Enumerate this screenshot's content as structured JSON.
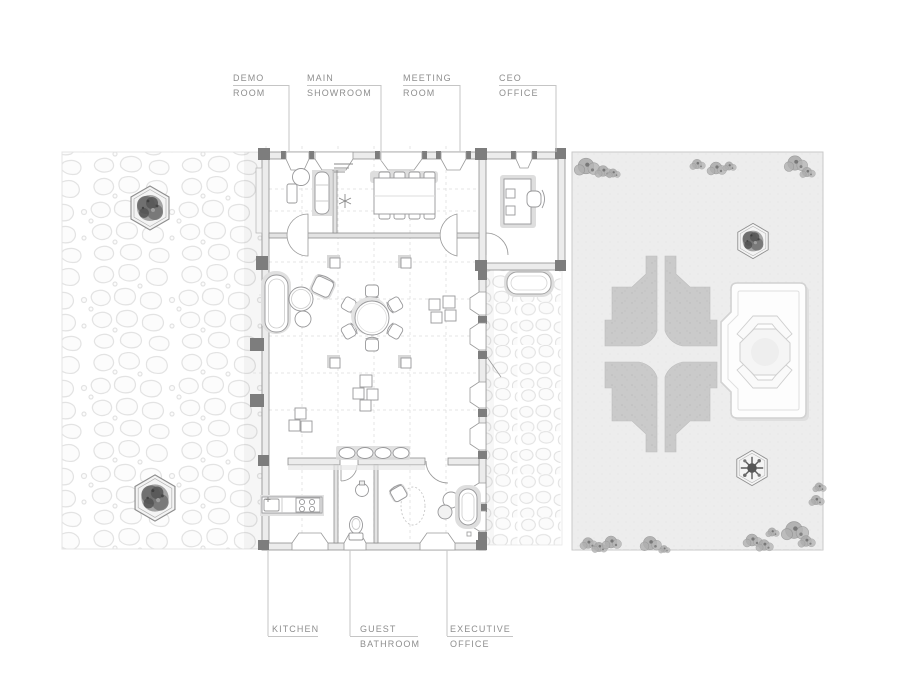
{
  "document": {
    "kind": "architectural floor plan drawing",
    "background": "#ffffff"
  },
  "labels": {
    "top": [
      {
        "id": "demo-room",
        "line1": "DEMO",
        "line2": "ROOM"
      },
      {
        "id": "main-showroom",
        "line1": "MAIN",
        "line2": "SHOWROOM"
      },
      {
        "id": "meeting-room",
        "line1": "MEETING",
        "line2": "ROOM"
      },
      {
        "id": "ceo-office",
        "line1": "CEO",
        "line2": "OFFICE"
      }
    ],
    "bottom": [
      {
        "id": "kitchen",
        "line1": "KITCHEN",
        "line2": ""
      },
      {
        "id": "guest-bathroom",
        "line1": "GUEST",
        "line2": "BATHROOM"
      },
      {
        "id": "executive-office",
        "line1": "EXECUTIVE",
        "line2": "OFFICE"
      }
    ]
  },
  "plan": {
    "rooms": [
      "Demo Room",
      "Main Showroom",
      "Meeting Room",
      "CEO Office",
      "Kitchen",
      "Guest Bathroom",
      "Executive Office"
    ],
    "outdoor": {
      "left": "stone-paved plaza with 2 hexagonal tree planters",
      "right": "gravel garden with 4-quadrant parterre, octagonal pavilion, 2 hexagonal tree planters and scattered shrubs",
      "courtyard": "stone-paved side courtyard with bench"
    },
    "furniture_counts": {
      "meeting_table_chairs": 8,
      "round_table_chairs": 6,
      "showroom_columns": 4,
      "display_cubes": 11,
      "hexagonal_planters": 4,
      "courtyard_bench": 1
    }
  },
  "colors": {
    "wall_line": "#8e8e8e",
    "pier_fill": "#7d7d7d",
    "wall_fill": "#ececec",
    "furniture_line": "#98989a",
    "grid_dash": "#dedede",
    "stone_outline": "#e3e3e3",
    "garden_fill": "#ededed",
    "parterre_fill": "#cacaca",
    "label_text": "#8e8e8e",
    "leader_line": "#c5c5c5"
  }
}
